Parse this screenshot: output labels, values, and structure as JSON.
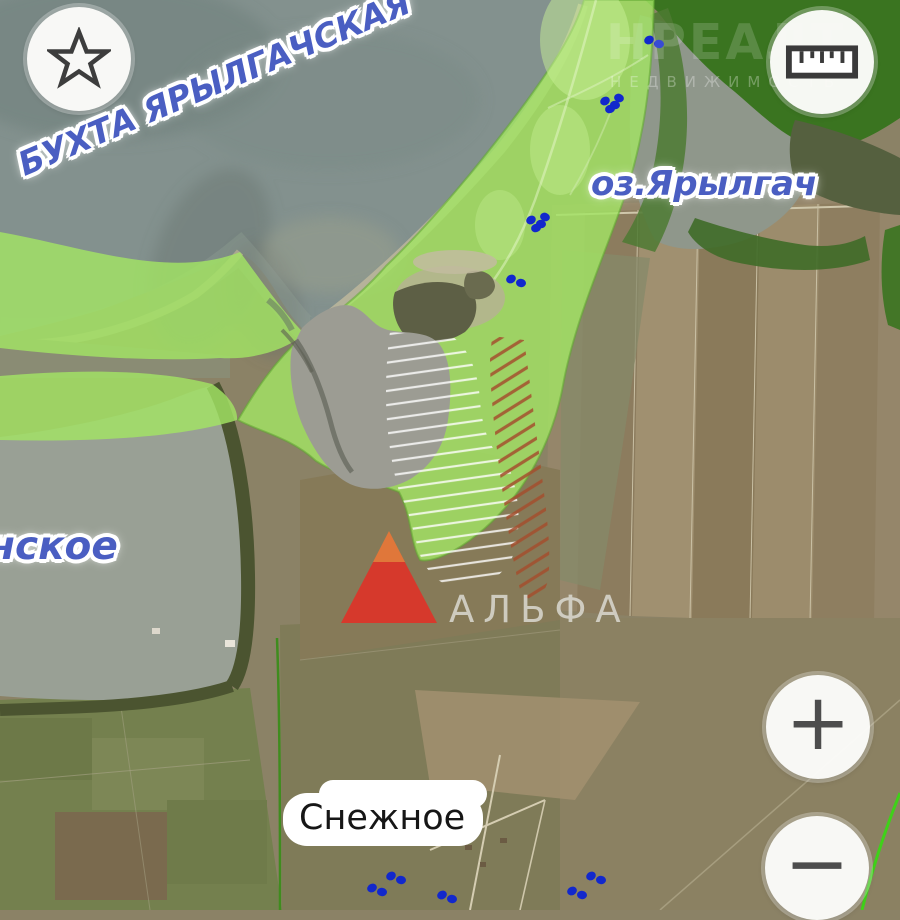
{
  "map": {
    "labels": {
      "bay": "БУХТА ЯРЫЛГАЧСКАЯ",
      "lake": "оз.Ярылгач",
      "lake_left_partial": "нское",
      "village": "Снежное",
      "landmark": "АЛЬФА"
    },
    "watermark": {
      "line1": "НРЕАЛТ",
      "line2": "НЕДВИЖИМОСТЬ"
    },
    "colors": {
      "highlight_green": "#a2e464",
      "highlight_green_edge": "#60a832",
      "dark_green_zone": "#3a7420",
      "water_gray": "#83918e",
      "lake_gray": "#8f978b",
      "marker_red": "#d6392c",
      "marker_orange": "#e0773a",
      "poi_blue": "#1228cc",
      "label_blue": "#4a5ec2",
      "hatch_white": "#ffffff",
      "hatch_red": "#a34f2e",
      "cadastral_neon": "#3fd119"
    },
    "poi_clusters": [
      {
        "x": 655,
        "y": 41,
        "dots": 2
      },
      {
        "x": 611,
        "y": 102,
        "dots": 4
      },
      {
        "x": 537,
        "y": 221,
        "dots": 4
      },
      {
        "x": 517,
        "y": 280,
        "dots": 2
      },
      {
        "x": 378,
        "y": 889,
        "dots": 2
      },
      {
        "x": 397,
        "y": 877,
        "dots": 2
      },
      {
        "x": 448,
        "y": 896,
        "dots": 2
      },
      {
        "x": 578,
        "y": 892,
        "dots": 2
      },
      {
        "x": 597,
        "y": 877,
        "dots": 2
      }
    ]
  },
  "controls": {
    "favorite_icon": "star-icon",
    "measure_icon": "ruler-icon",
    "zoom_in_glyph": "+",
    "zoom_out_glyph": "−"
  }
}
